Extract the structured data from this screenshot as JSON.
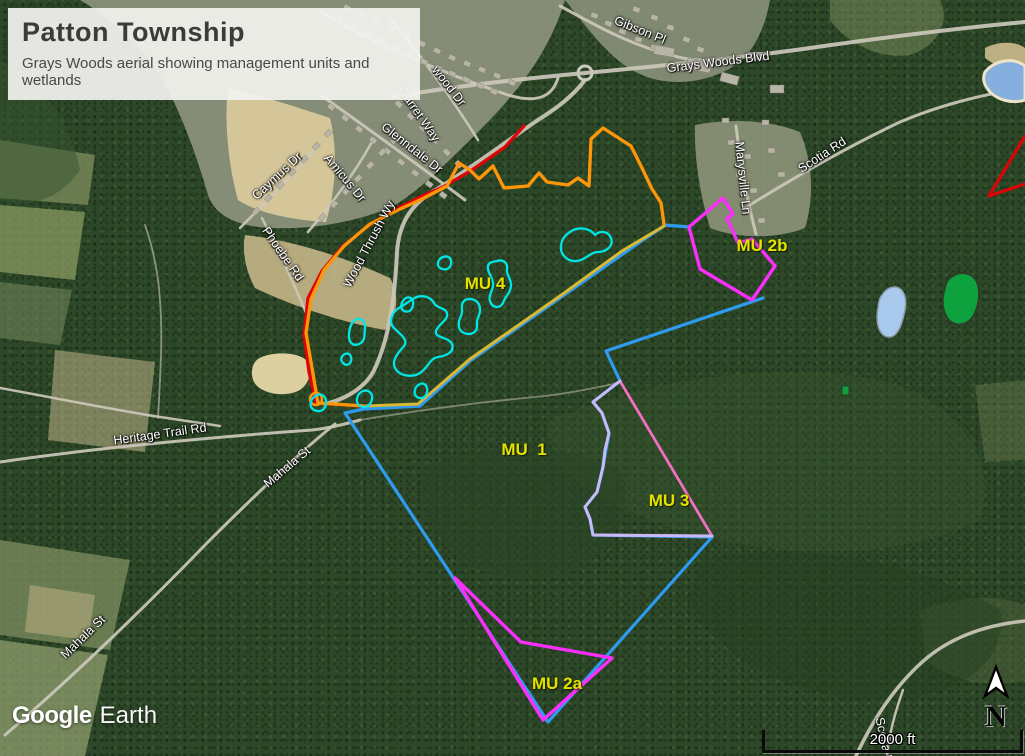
{
  "title_card": {
    "title": "Patton Township",
    "subtitle": "Grays Woods aerial showing management units and wetlands"
  },
  "logo": {
    "part1": "Google",
    "part2": "Earth"
  },
  "scale_bar": {
    "label": "2000 ft"
  },
  "north": {
    "label": "N"
  },
  "unit_labels": [
    {
      "text": "MU 4",
      "x": 485,
      "y": 284
    },
    {
      "text": "MU  1",
      "x": 524,
      "y": 450
    },
    {
      "text": "MU 3",
      "x": 669,
      "y": 501
    },
    {
      "text": "MU 2b",
      "x": 762,
      "y": 246
    },
    {
      "text": "MU 2a",
      "x": 557,
      "y": 684
    }
  ],
  "road_labels": [
    {
      "text": "Gibson Pl",
      "x": 640,
      "y": 30,
      "rot": 22
    },
    {
      "text": "Grays Woods Blvd",
      "x": 718,
      "y": 62,
      "rot": -7
    },
    {
      "text": "wood Dr",
      "x": 449,
      "y": 86,
      "rot": 52
    },
    {
      "text": "Garret Way",
      "x": 419,
      "y": 114,
      "rot": 55
    },
    {
      "text": "Glenndale Dr",
      "x": 412,
      "y": 148,
      "rot": 38
    },
    {
      "text": "Caymus Dr",
      "x": 277,
      "y": 176,
      "rot": -43
    },
    {
      "text": "Amicus Dr",
      "x": 345,
      "y": 178,
      "rot": 50
    },
    {
      "text": "Phoebe Rd",
      "x": 283,
      "y": 254,
      "rot": 55
    },
    {
      "text": "Wood Thrush Wy",
      "x": 369,
      "y": 244,
      "rot": -62
    },
    {
      "text": "Marysville Ln",
      "x": 743,
      "y": 178,
      "rot": 84
    },
    {
      "text": "Scotia Rd",
      "x": 822,
      "y": 155,
      "rot": -33
    },
    {
      "text": "Heritage Trail Rd",
      "x": 160,
      "y": 434,
      "rot": -8
    },
    {
      "text": "Mahala St",
      "x": 287,
      "y": 467,
      "rot": -40
    },
    {
      "text": "Mahala St",
      "x": 83,
      "y": 637,
      "rot": -44
    },
    {
      "text": "Scotia Rd",
      "x": 885,
      "y": 744,
      "rot": 78
    }
  ],
  "map": {
    "road_color": "#ccc8bb",
    "wetland_color": "#00e6e6",
    "building_fill": "#b8b4a6",
    "patches": [
      {
        "name": "suburb-area",
        "d": "M80,0 L565,0 C550,50 520,90 480,130 C445,165 420,190 395,205 C360,222 310,230 270,228 C235,226 215,215 208,195 C195,150 175,95 150,60 C130,35 105,15 80,0 Z",
        "fill": "#8f957f",
        "op": 0.9
      },
      {
        "name": "suburb-area-ne",
        "d": "M565,0 L770,0 C765,28 755,48 740,62 C718,78 688,86 658,80 C620,72 598,42 565,0 Z",
        "fill": "#8f957f",
        "op": 0.85
      },
      {
        "name": "cleared-dirt-strip",
        "d": "M228,88 C260,95 300,108 330,118 C338,150 336,190 326,222 C290,220 255,212 238,200 C228,165 224,120 228,88 Z",
        "fill": "#d9c99b",
        "op": 0.95
      },
      {
        "name": "cleared-dirt-lower",
        "d": "M245,235 C290,240 340,255 390,278 C400,295 398,315 385,330 C340,322 290,305 255,288 C245,270 242,250 245,235 Z",
        "fill": "#cfbd8e",
        "op": 0.85
      },
      {
        "name": "left-fields-1",
        "d": "M0,140 L95,155 L88,205 L0,198 Z",
        "fill": "#7b8b5a",
        "op": 0.8
      },
      {
        "name": "left-fields-2",
        "d": "M0,205 L85,212 L75,280 L0,272 Z",
        "fill": "#8fa065",
        "op": 0.7
      },
      {
        "name": "left-fields-3",
        "d": "M0,282 L72,290 L60,345 L0,338 Z",
        "fill": "#70835a",
        "op": 0.6
      },
      {
        "name": "left-cleared-mid",
        "d": "M55,350 L155,362 L145,452 L48,440 Z",
        "fill": "#cdbd92",
        "op": 0.5
      },
      {
        "name": "farm-sw-1",
        "d": "M0,540 L130,560 L110,650 L0,635 Z",
        "fill": "#7f8f60",
        "op": 0.75
      },
      {
        "name": "farm-sw-2",
        "d": "M0,640 L108,655 L85,756 L0,756 Z",
        "fill": "#96a472",
        "op": 0.7
      },
      {
        "name": "farm-sw-3",
        "d": "M30,585 L95,595 L88,640 L25,632 Z",
        "fill": "#c3b488",
        "op": 0.5
      },
      {
        "name": "marysville-clearing",
        "d": "M695,125 C730,118 770,120 800,132 C812,160 815,195 805,228 C775,240 735,238 710,228 C700,195 694,158 695,125 Z",
        "fill": "#93997e",
        "op": 0.85
      },
      {
        "name": "field-ne",
        "d": "M830,0 L940,0 C950,20 940,45 910,55 C875,60 845,40 830,20 Z",
        "fill": "#7d8f60",
        "op": 0.5
      },
      {
        "name": "field-e",
        "d": "M975,385 L1025,380 L1025,460 L985,462 Z",
        "fill": "#6e7f52",
        "op": 0.4
      },
      {
        "name": "clearing-se",
        "d": "M920,610 C960,595 1000,595 1025,605 L1025,680 C990,690 950,680 925,660 Z",
        "fill": "#55663f",
        "op": 0.45
      },
      {
        "name": "forest-light-1",
        "d": "M550,420 C650,380 760,360 880,380 C960,400 1000,460 980,520 C900,560 780,560 680,530 C600,505 540,470 550,420 Z",
        "fill": "#36552e",
        "op": 0.4
      },
      {
        "name": "forest-dark-1",
        "d": "M700,560 C800,540 920,560 1000,610 C1010,660 960,700 880,700 C790,700 710,650 690,600 Z",
        "fill": "#243f20",
        "op": 0.5
      },
      {
        "name": "forest-light-2",
        "d": "M0,60 C40,80 70,120 80,170 C60,200 25,210 0,200 Z",
        "fill": "#355430",
        "op": 0.5
      },
      {
        "name": "forest-dark-2",
        "d": "M420,470 C480,440 560,440 620,470 C640,520 600,570 540,580 C470,585 420,540 420,470 Z",
        "fill": "#2a4526",
        "op": 0.55
      },
      {
        "name": "sediment-basin",
        "d": "M255,362 C262,352 295,350 306,360 C314,368 310,385 298,391 C282,398 260,393 254,382 C251,376 251,368 255,362 Z",
        "fill": "#e6d7a6",
        "op": 0.95
      },
      {
        "name": "pond-shore-ne",
        "d": "M985,48 C1000,40 1018,42 1025,48 L1025,74 C1010,72 995,66 985,58 Z",
        "fill": "#cdbb8d",
        "op": 0.9
      }
    ],
    "roads": [
      {
        "d": "M393,97 C460,85 530,78 585,73 C660,66 740,58 810,48 C880,38 960,28 1025,22",
        "w": 4
      },
      {
        "d": "M560,6 C590,22 620,40 660,52 C680,58 690,60 700,60",
        "w": 3
      },
      {
        "d": "M585,80 C570,100 550,112 535,122 C500,146 468,170 437,189 C412,203 399,222 397,252 C395,292 391,332 376,366 C369,384 350,398 325,404",
        "w": 4
      },
      {
        "d": "M0,462 C90,449 200,438 312,430 C330,428 345,424 360,420",
        "w": 3
      },
      {
        "d": "M360,420 C420,410 480,402 545,396 C570,393 595,388 618,383",
        "w": 1.8,
        "op": 0.5
      },
      {
        "d": "M335,424 C300,452 255,495 205,545 C150,602 75,675 5,735",
        "w": 3
      },
      {
        "d": "M322,12 C370,42 440,72 505,94 C535,104 552,98 558,78",
        "w": 3
      },
      {
        "d": "M390,18 C420,55 450,95 478,140",
        "w": 2.6
      },
      {
        "d": "M322,96 C370,130 425,170 465,200",
        "w": 3
      },
      {
        "d": "M240,228 C268,200 295,172 318,146",
        "w": 2.6
      },
      {
        "d": "M308,232 C332,204 355,172 372,142",
        "w": 2.6
      },
      {
        "d": "M262,218 C278,250 295,285 308,318",
        "w": 2.4
      },
      {
        "d": "M736,126 C740,160 746,196 756,234",
        "w": 3
      },
      {
        "d": "M745,208 C790,180 845,148 900,122 C940,105 980,95 1025,88",
        "w": 3
      },
      {
        "d": "M856,756 C875,715 898,682 928,657 C958,633 995,624 1025,621",
        "w": 3.5
      },
      {
        "d": "M903,690 C894,715 889,735 887,756",
        "w": 2.5
      },
      {
        "d": "M0,388 C55,398 115,410 160,417 C180,420 200,423 220,426",
        "w": 2.5
      },
      {
        "d": "M158,418 C160,380 163,340 160,300 C158,270 152,245 145,225",
        "w": 1.8,
        "op": 0.6
      }
    ],
    "roundabout": {
      "cx": 585,
      "cy": 73,
      "r": 7
    },
    "buildings": [
      [
        338,
        16,
        7,
        5,
        25
      ],
      [
        352,
        23,
        7,
        5,
        25
      ],
      [
        366,
        30,
        7,
        5,
        25
      ],
      [
        380,
        37,
        7,
        5,
        25
      ],
      [
        394,
        44,
        7,
        5,
        25
      ],
      [
        408,
        51,
        7,
        5,
        25
      ],
      [
        422,
        58,
        7,
        5,
        25
      ],
      [
        436,
        64,
        7,
        5,
        25
      ],
      [
        450,
        70,
        7,
        5,
        25
      ],
      [
        464,
        76,
        7,
        5,
        25
      ],
      [
        478,
        82,
        7,
        5,
        25
      ],
      [
        492,
        88,
        7,
        5,
        25
      ],
      [
        345,
        4,
        7,
        5,
        25
      ],
      [
        360,
        10,
        7,
        5,
        25
      ],
      [
        375,
        17,
        7,
        5,
        25
      ],
      [
        390,
        24,
        7,
        5,
        25
      ],
      [
        405,
        32,
        7,
        5,
        25
      ],
      [
        420,
        40,
        7,
        5,
        25
      ],
      [
        435,
        47,
        7,
        5,
        25
      ],
      [
        450,
        54,
        7,
        5,
        25
      ],
      [
        465,
        60,
        7,
        5,
        25
      ],
      [
        480,
        66,
        7,
        5,
        25
      ],
      [
        495,
        72,
        7,
        5,
        25
      ],
      [
        510,
        79,
        7,
        5,
        25
      ],
      [
        398,
        100,
        7,
        5,
        45
      ],
      [
        410,
        112,
        7,
        5,
        45
      ],
      [
        422,
        124,
        7,
        5,
        45
      ],
      [
        434,
        136,
        7,
        5,
        45
      ],
      [
        446,
        148,
        7,
        5,
        45
      ],
      [
        458,
        160,
        7,
        5,
        45
      ],
      [
        330,
        103,
        7,
        5,
        38
      ],
      [
        344,
        114,
        7,
        5,
        38
      ],
      [
        358,
        125,
        7,
        5,
        38
      ],
      [
        372,
        136,
        7,
        5,
        38
      ],
      [
        386,
        147,
        7,
        5,
        38
      ],
      [
        400,
        158,
        7,
        5,
        38
      ],
      [
        414,
        169,
        7,
        5,
        38
      ],
      [
        428,
        180,
        7,
        5,
        38
      ],
      [
        442,
        191,
        7,
        5,
        38
      ],
      [
        252,
        212,
        7,
        5,
        -45
      ],
      [
        264,
        199,
        7,
        5,
        -45
      ],
      [
        276,
        186,
        7,
        5,
        -45
      ],
      [
        288,
        173,
        7,
        5,
        -45
      ],
      [
        300,
        160,
        7,
        5,
        -45
      ],
      [
        312,
        147,
        7,
        5,
        -45
      ],
      [
        324,
        134,
        7,
        5,
        -45
      ],
      [
        318,
        218,
        7,
        5,
        -45
      ],
      [
        330,
        205,
        7,
        5,
        -45
      ],
      [
        342,
        192,
        7,
        5,
        -45
      ],
      [
        354,
        179,
        7,
        5,
        -45
      ],
      [
        366,
        166,
        7,
        5,
        -45
      ],
      [
        378,
        153,
        7,
        5,
        -45
      ],
      [
        390,
        141,
        7,
        5,
        -45
      ],
      [
        592,
        12,
        7,
        5,
        20
      ],
      [
        606,
        20,
        7,
        5,
        20
      ],
      [
        620,
        28,
        7,
        5,
        20
      ],
      [
        636,
        36,
        7,
        5,
        20
      ],
      [
        652,
        44,
        7,
        5,
        20
      ],
      [
        668,
        24,
        7,
        5,
        20
      ],
      [
        652,
        14,
        7,
        5,
        20
      ],
      [
        634,
        6,
        7,
        5,
        20
      ],
      [
        684,
        36,
        7,
        5,
        20
      ],
      [
        698,
        46,
        7,
        5,
        20
      ],
      [
        655,
        45,
        20,
        9,
        10
      ],
      [
        688,
        58,
        24,
        11,
        10
      ],
      [
        722,
        72,
        18,
        9,
        15
      ],
      [
        748,
        52,
        16,
        8,
        0
      ],
      [
        770,
        85,
        14,
        8,
        0
      ],
      [
        728,
        140,
        7,
        5,
        0
      ],
      [
        744,
        154,
        7,
        5,
        0
      ],
      [
        736,
        172,
        7,
        5,
        0
      ],
      [
        750,
        188,
        7,
        5,
        0
      ],
      [
        742,
        206,
        7,
        5,
        0
      ],
      [
        758,
        218,
        7,
        5,
        0
      ],
      [
        768,
        148,
        7,
        5,
        0
      ],
      [
        778,
        172,
        7,
        5,
        0
      ],
      [
        762,
        120,
        7,
        5,
        0
      ],
      [
        722,
        118,
        7,
        5,
        0
      ]
    ],
    "ponds": [
      {
        "name": "pond-ne-blue",
        "d": "M985,72 C995,60 1012,58 1022,64 L1025,66 L1025,100 C1012,104 998,100 990,92 C984,85 982,79 985,72 Z",
        "fill": "#86aede",
        "stroke": "#ece4c6",
        "sw": 3
      },
      {
        "name": "pond-light-blue",
        "d": "M882,295 C888,286 898,284 903,292 C908,300 905,312 902,322 C899,332 893,340 885,336 C877,332 876,318 878,308 C879,301 879,299 882,295 Z",
        "fill": "#a9c9ec",
        "stroke": "#8c9cae",
        "sw": 1.5
      },
      {
        "name": "pond-green",
        "d": "M950,278 C960,270 972,272 977,282 C981,291 979,305 974,315 C969,324 958,328 950,321 C943,315 941,302 944,291 C946,284 946,281 950,278 Z",
        "fill": "#0da23e",
        "stroke": "#2e3c2a",
        "sw": 2
      },
      {
        "name": "pond-green-small",
        "d": "M842,386 L849,386 L849,395 L842,395 Z",
        "fill": "#0da23e",
        "stroke": "#2e3c2a",
        "sw": 1
      }
    ],
    "overlays": [
      {
        "name": "mu1-boundary-blue",
        "color": "#2f9bf0",
        "w": 3.2,
        "d": "M664,226 L640,242 L560,298 L470,361 L420,406 L364,409 L345,413 L548,722 L712,537 L593,535 L590,519 L585,507 L597,492 L603,467 L609,433 L602,413 L593,402 L620,381 L606,351 L763,298"
      },
      {
        "name": "mu1-boundary-blue-2",
        "color": "#2f9bf0",
        "w": 3.2,
        "d": "M664,225 L689,227"
      },
      {
        "name": "mu4-south-yellow",
        "color": "#d9b832",
        "w": 3,
        "d": "M320,403 L364,406 L418,404 L470,359 L560,296 L622,251 L664,226"
      },
      {
        "name": "red-road-line",
        "color": "#dc0404",
        "w": 3.2,
        "d": "M524,126 L505,147 L472,170 L443,187 L420,197 L396,209 L368,226 L342,247 L322,271 L308,298 L304,335 L309,372 L316,403 L361,406"
      },
      {
        "name": "red-edge-mark",
        "color": "#dc0404",
        "w": 3.2,
        "d": "M1025,136 L989,196 L1025,184"
      },
      {
        "name": "orange-boundary",
        "color": "#ff9508",
        "w": 3.3,
        "d": "M318,403 L306,333 L311,299 L324,270 L344,246 L370,224 L398,210 L422,199 L447,186 L459,163 L470,170 L479,179 L493,166 L504,188 L528,186 L539,173 L547,182 L568,185 L578,178 L589,186 L591,139 L603,128 L631,146 L642,168 L652,189 L661,203 L664,224"
      },
      {
        "name": "orange-boundary-south",
        "color": "#ff9508",
        "w": 3.3,
        "d": "M318,403 L364,406"
      },
      {
        "name": "orange-corner-loop",
        "color": "#ff9508",
        "w": 2.5,
        "d": "M310,399 a6,6 0 1,0 12,0 a6,6 0 1,0 -12,0"
      },
      {
        "name": "mu2b-boundary-magenta",
        "color": "#fb2efb",
        "w": 3.4,
        "d": "M723,198 L733,214 L727,218 L738,243 L752,239 L775,266 L752,300 L700,269 L689,227 Z"
      },
      {
        "name": "mu2a-boundary-magenta",
        "color": "#fb2efb",
        "w": 3.4,
        "d": "M455,578 L521,642 L612,658 L543,720 Z"
      },
      {
        "name": "mu3-east-pink",
        "color": "#ef6fc0",
        "w": 2.8,
        "d": "M620,381 L712,536 L593,535"
      },
      {
        "name": "mu3-boundary-lavender",
        "color": "#c9baf7",
        "w": 3,
        "d": "M620,381 L593,402 L602,413 L609,433 L605,450 L603,467 L597,492 L585,507 L590,519 L593,535 L712,536"
      }
    ],
    "wetlands": [
      "M413,299 C420,294 430,296 434,303 C437,309 445,307 447,313 C449,320 438,324 436,331 C434,338 449,337 452,344 C455,352 446,356 438,357 C430,358 428,368 420,373 C412,378 399,376 395,368 C391,360 399,352 404,346 C409,340 400,334 394,328 C388,322 392,312 399,308 C404,305 408,302 413,299 Z",
      "M355,320 C361,317 366,321 365,328 C364,335 366,341 359,344 C352,347 348,341 349,333 C350,327 351,323 355,320 Z",
      "M406,298 C411,296 414,300 413,305 C412,310 409,313 404,311 C400,309 400,302 406,298 Z",
      "M465,300 C472,297 479,301 480,308 C481,315 476,318 477,325 C478,332 471,336 464,333 C457,330 458,322 461,316 C464,310 459,305 465,300 Z",
      "M570,232 C578,226 590,228 595,235 C600,230 608,231 611,238 C614,246 606,252 598,252 C590,252 586,260 577,261 C568,262 560,255 561,246 C562,239 564,236 570,232 Z",
      "M443,257 C449,255 452,259 451,264 C450,269 445,271 440,268 C436,265 438,259 443,257 Z",
      "M497,261 C503,259 508,263 507,269 C506,275 511,278 511,285 C511,293 505,296 503,303 C500,309 492,308 490,301 C488,294 494,290 493,283 C492,276 487,272 488,266 C489,262 492,262 497,261 Z",
      "M317,395 C323,393 327,398 326,404 C325,410 320,413 314,410 C309,407 309,399 317,395 Z",
      "M363,391 C369,389 373,394 372,399 C371,405 366,409 360,406 C355,403 356,394 363,391 Z",
      "M420,384 C425,382 428,387 427,392 C426,397 422,400 417,397 C413,394 414,387 420,384 Z",
      "M345,354 C350,352 352,357 351,361 C350,365 346,366 343,363 C340,360 341,356 345,354 Z"
    ]
  }
}
